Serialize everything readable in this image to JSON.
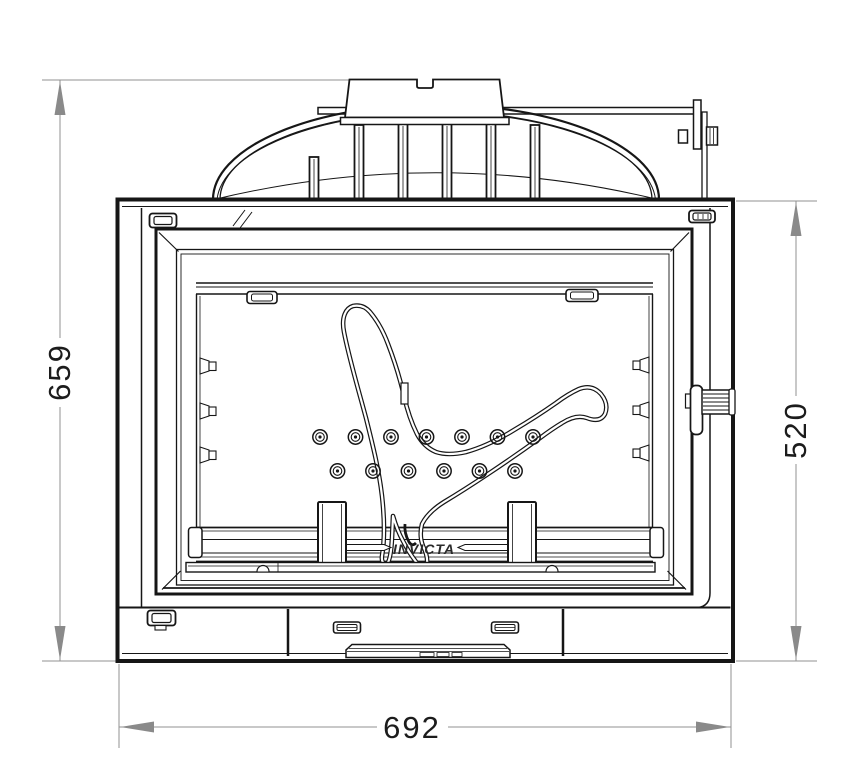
{
  "drawing": {
    "type": "technical-front-elevation",
    "subject": "fireplace-insert",
    "brand_label": "INVICTA",
    "dimensions": {
      "overall_height": "659",
      "body_height": "520",
      "overall_width": "692"
    },
    "style": {
      "line_color": "#161616",
      "dimension_line_color": "#909090",
      "dimension_arrow_color": "#8a8a8a",
      "dimension_text_color": "#1c1c1c",
      "background": "#ffffff"
    }
  }
}
